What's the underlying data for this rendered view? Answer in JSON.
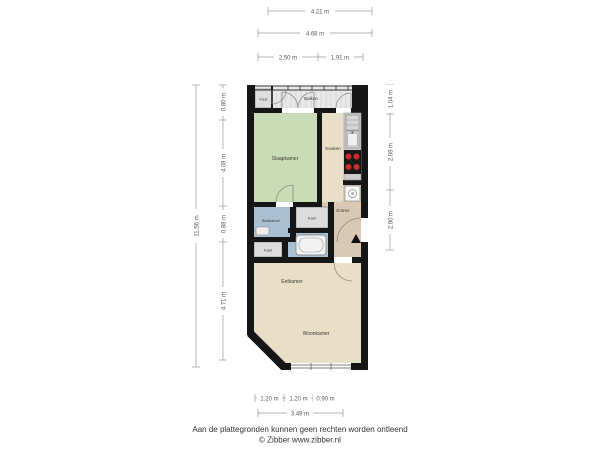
{
  "plan": {
    "rooms": {
      "kast_top": "Kast",
      "balkon": "Balkon",
      "slaapkamer": "Slaapkamer",
      "keuken": "Keuken",
      "entree": "Entree",
      "badkamer": "Badkamer",
      "kast_mid": "Kast",
      "kast_low": "Kast",
      "eetkamer": "Eetkamer",
      "woonkamer": "Woonkamer"
    },
    "dimensions": {
      "top": [
        "4.21 m",
        "4.68 m",
        "2.50 m",
        "1.91 m"
      ],
      "left": [
        "11.56 m",
        "0.80 m",
        "4.08 m",
        "0.88 m",
        "4.71 m"
      ],
      "right": [
        "1.04 m",
        "2.08 m",
        "2.80 m"
      ],
      "bottom": [
        "1.20 m",
        "1.20 m",
        "0.90 m",
        "3.49 m"
      ]
    },
    "colors": {
      "wall": "#161616",
      "slaapkamer": "#cadcb5",
      "keuken_eetkamer": "#e8dfc6",
      "entree": "#d9c8b2",
      "badkamer": "#a9bfd2",
      "kast": "#dcdcdc",
      "balkon": "#e8e8e8",
      "counter": "#cccccc",
      "stove": "#191919",
      "burner": "#cf2a2a",
      "dimension_text": "#5a5a5a"
    }
  },
  "footer": {
    "line1": "Aan de plattegronden kunnen geen rechten worden ontleend",
    "line2": "© Zibber www.zibber.nl"
  }
}
